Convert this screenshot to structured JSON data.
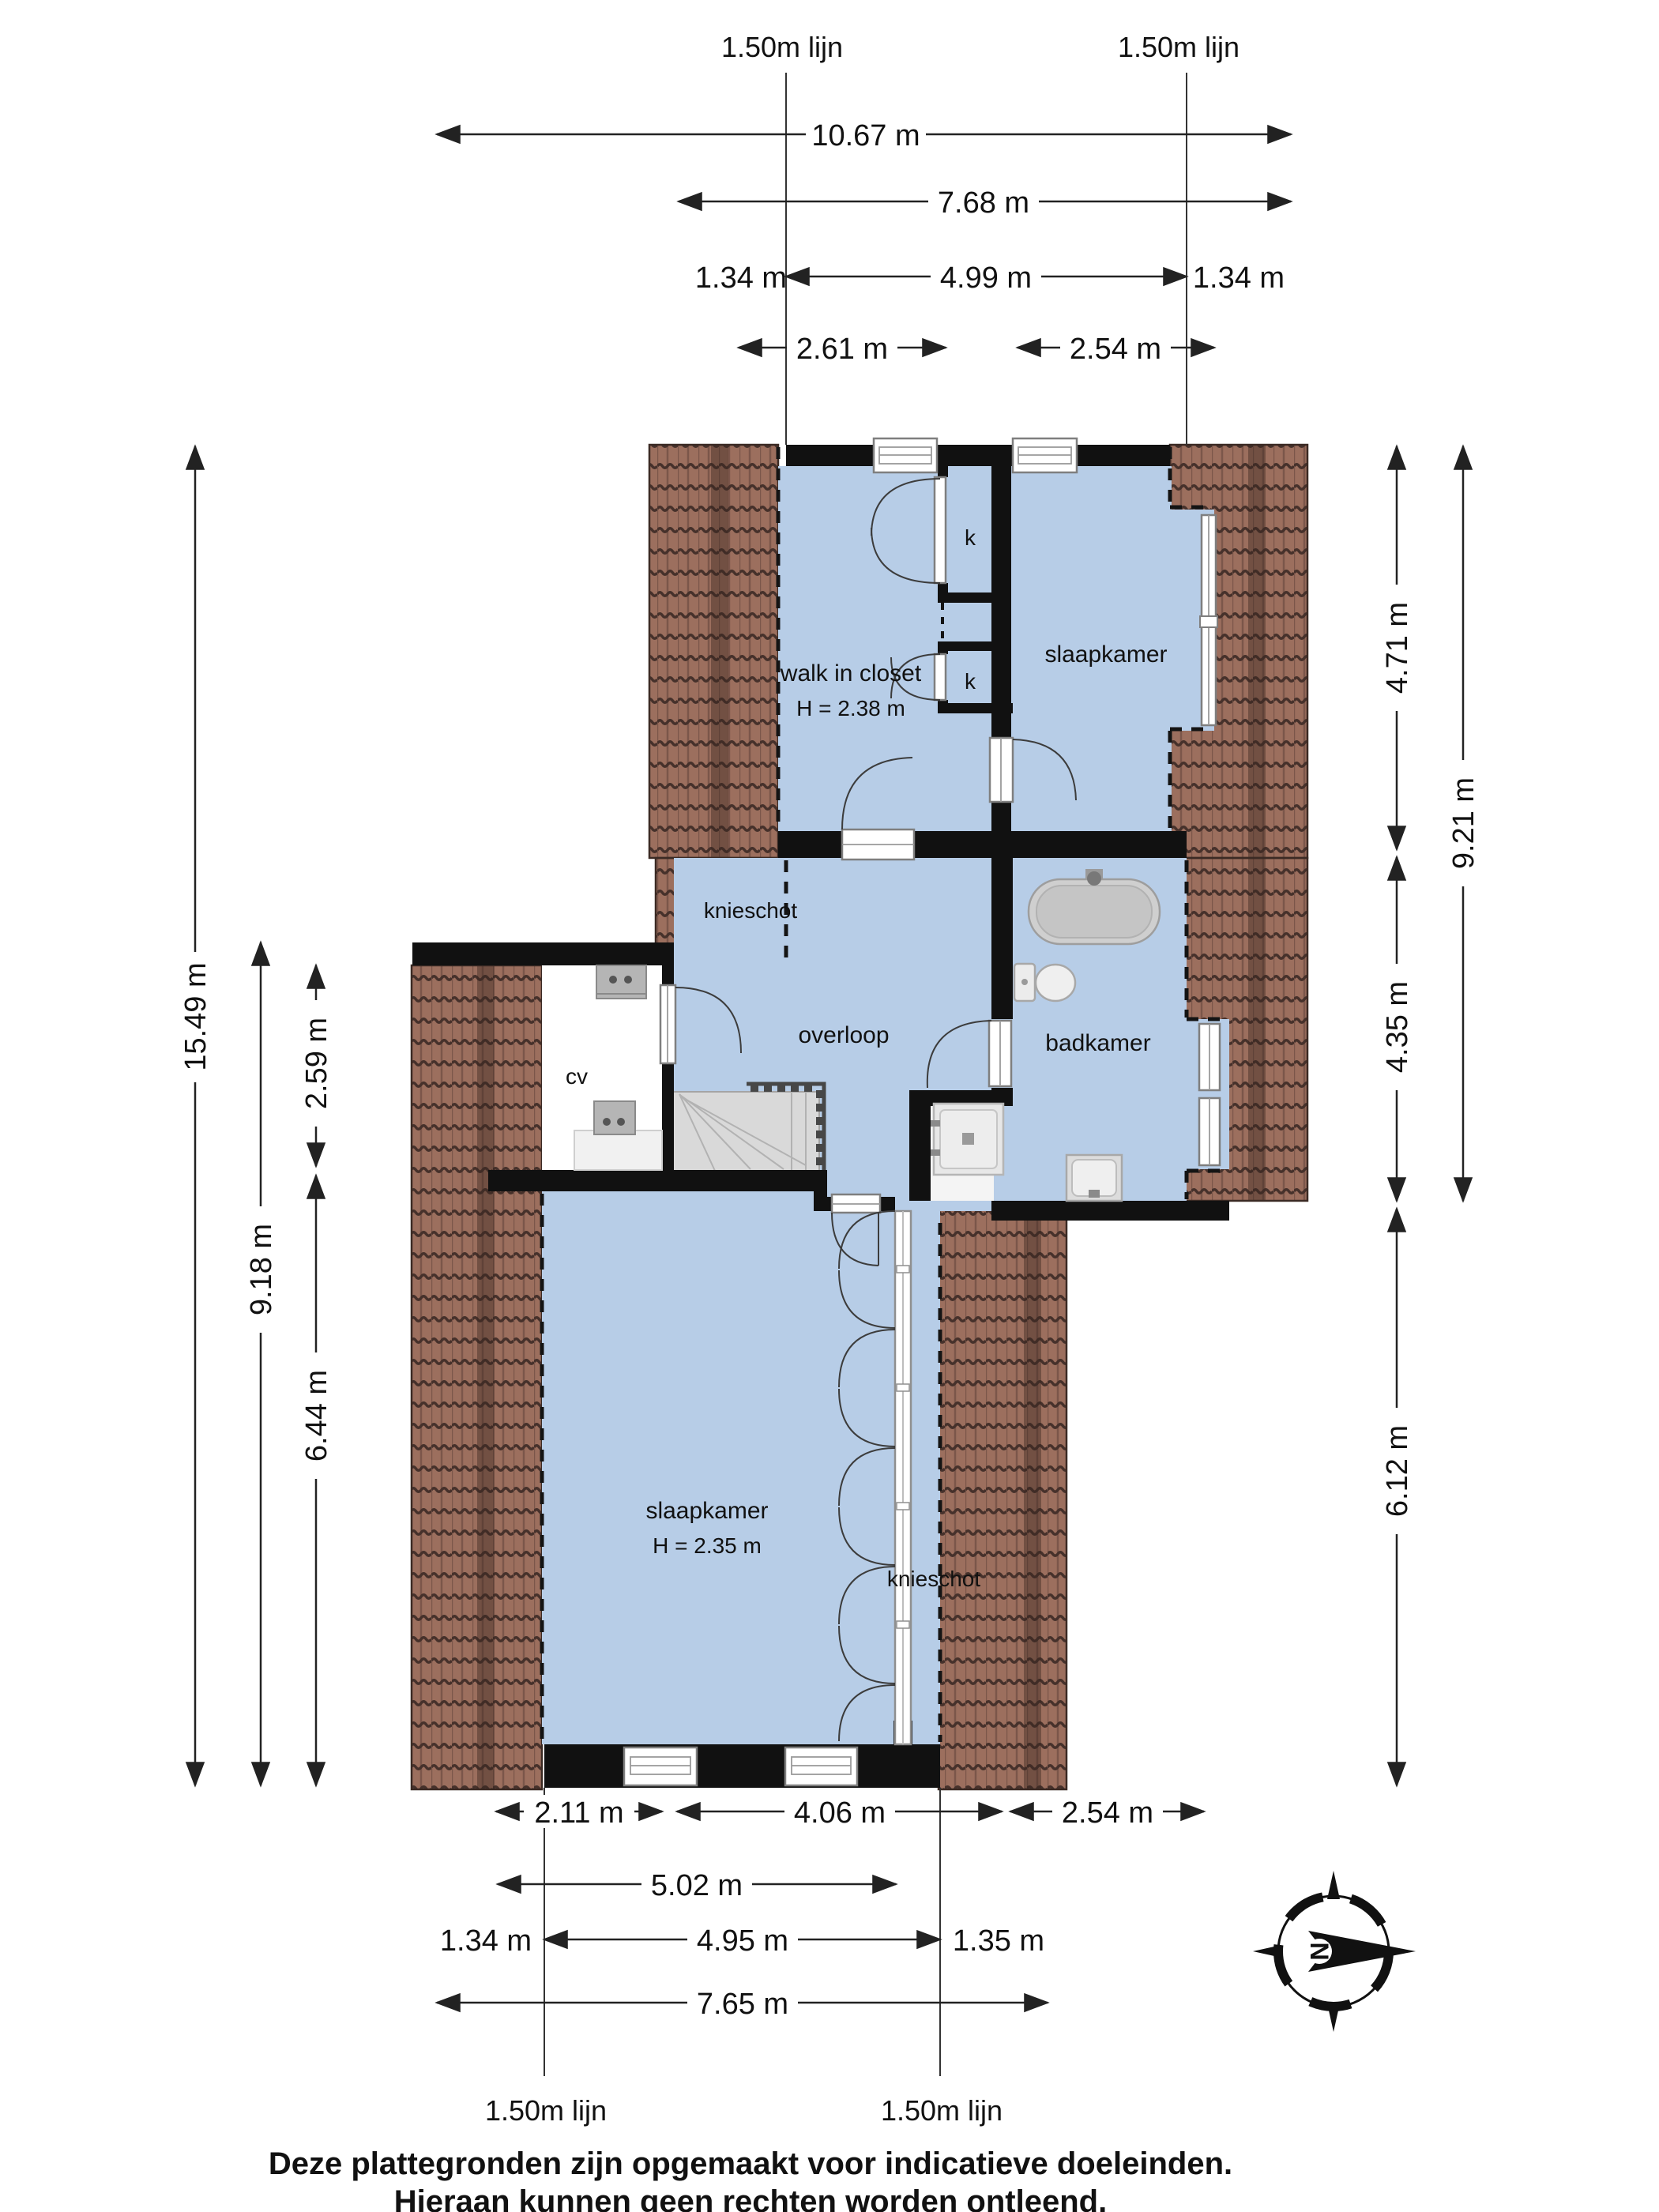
{
  "colors": {
    "room_fill": "#b7cde7",
    "roof_base": "#9c6f5e",
    "roof_scallop": "#46312b",
    "wall": "#111111",
    "dim": "#222222"
  },
  "guide_lines": {
    "top_left": "1.50m lijn",
    "top_right": "1.50m lijn",
    "bottom_left": "1.50m lijn",
    "bottom_right": "1.50m lijn"
  },
  "dimensions": {
    "top_total": "10.67 m",
    "top_building": "7.68 m",
    "top_left_offset": "1.34 m",
    "top_span": "4.99 m",
    "top_right_offset": "1.34 m",
    "top_room_left": "2.61 m",
    "top_room_right": "2.54 m",
    "right_upper": "4.71 m",
    "right_middle": "4.35 m",
    "right_total": "9.21 m",
    "right_lower": "6.12 m",
    "left_total": "15.49 m",
    "left_lower_total": "9.18 m",
    "left_cv": "2.59 m",
    "left_bedroom": "6.44 m",
    "bottom_left_seg": "2.11 m",
    "bottom_mid_seg": "4.06 m",
    "bottom_right_seg": "2.54 m",
    "bottom_inner": "5.02 m",
    "bottom_left_offset": "1.34 m",
    "bottom_span": "4.95 m",
    "bottom_right_offset": "1.35 m",
    "bottom_total": "7.65 m"
  },
  "rooms": {
    "walk_in_closet": {
      "name": "walk in closet",
      "height": "H = 2.38 m"
    },
    "bedroom_top": {
      "name": "slaapkamer"
    },
    "knieschot_top": {
      "name": "knieschot"
    },
    "overloop": {
      "name": "overloop"
    },
    "badkamer": {
      "name": "badkamer"
    },
    "cv": {
      "name": "cv"
    },
    "bedroom_bottom": {
      "name": "slaapkamer",
      "height": "H = 2.35 m"
    },
    "knieschot_bottom": {
      "name": "knieschot"
    },
    "closet_top": {
      "label": "k"
    },
    "closet_mid": {
      "label": "k"
    }
  },
  "compass": {
    "north": "N"
  },
  "disclaimer": {
    "line1": "Deze plattegronden zijn opgemaakt voor indicatieve doeleinden.",
    "line2": "Hieraan kunnen geen rechten worden ontleend."
  }
}
